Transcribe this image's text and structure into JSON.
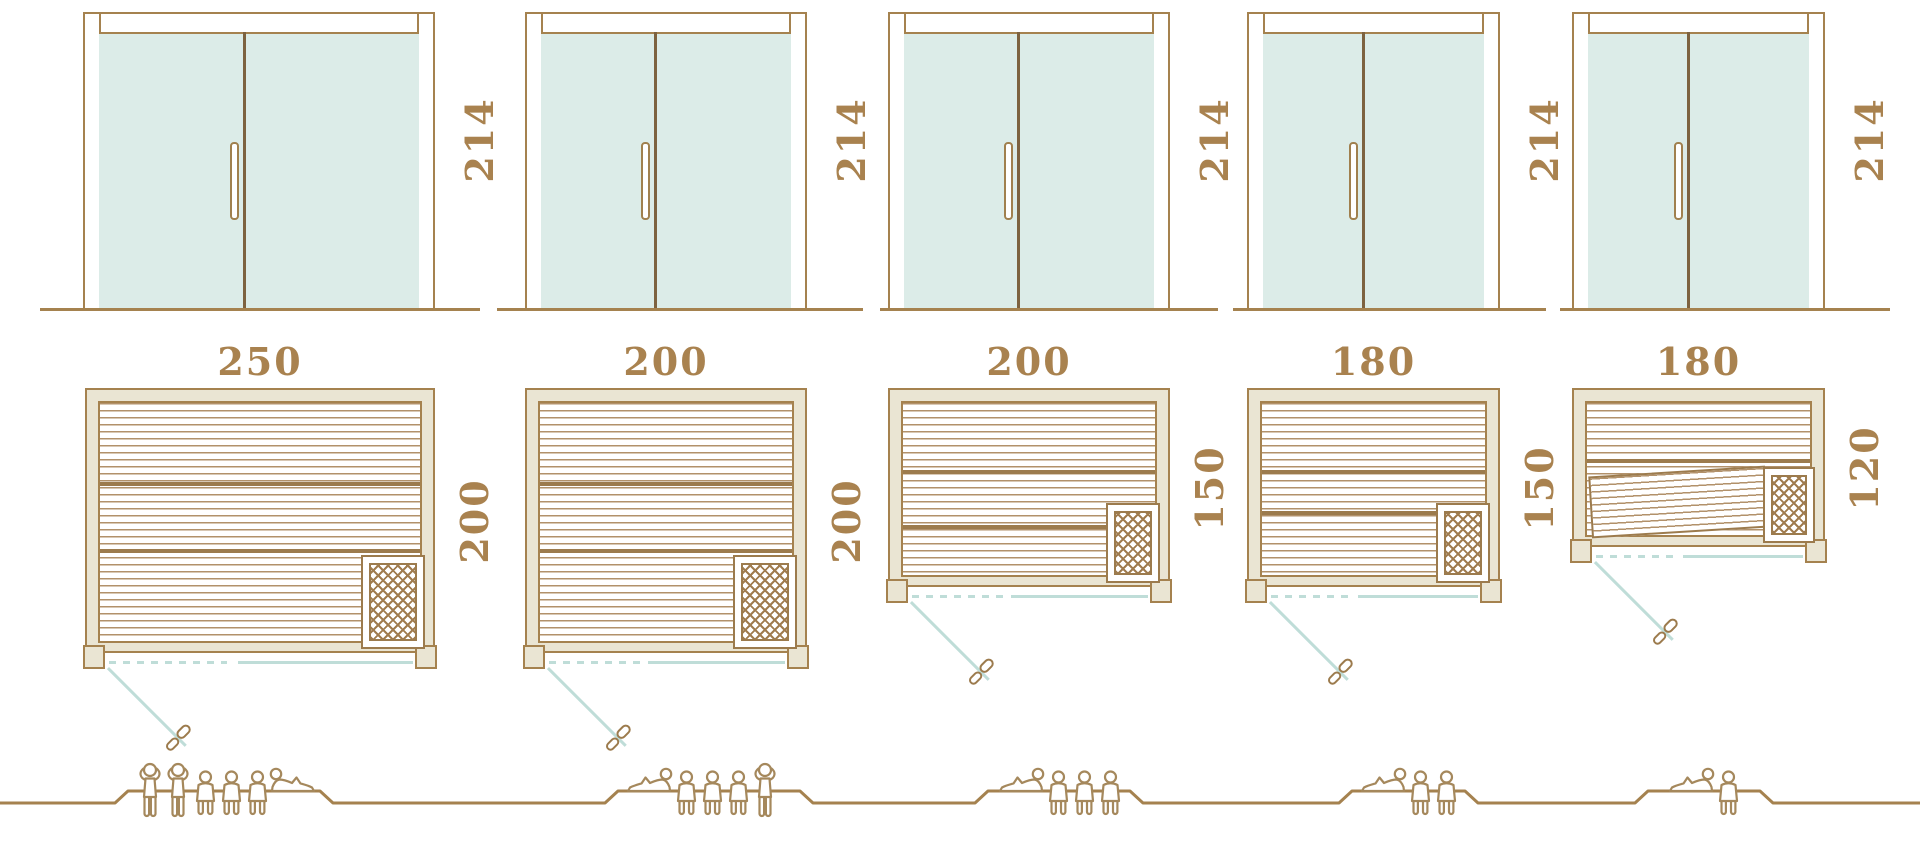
{
  "units": [
    {
      "door_height": "214",
      "plan_width": "250",
      "plan_depth": "200",
      "capacity": 6,
      "figures": [
        "standing",
        "standing",
        "seated",
        "seated",
        "seated",
        "reclining_mirrored"
      ]
    },
    {
      "door_height": "214",
      "plan_width": "200",
      "plan_depth": "200",
      "capacity": 5,
      "figures": [
        "reclining",
        "seated",
        "seated",
        "seated",
        "standing"
      ]
    },
    {
      "door_height": "214",
      "plan_width": "200",
      "plan_depth": "150",
      "capacity": 4,
      "figures": [
        "reclining",
        "seated",
        "seated",
        "seated"
      ]
    },
    {
      "door_height": "214",
      "plan_width": "180",
      "plan_depth": "150",
      "capacity": 3,
      "figures": [
        "reclining",
        "seated",
        "seated"
      ]
    },
    {
      "door_height": "214",
      "plan_width": "180",
      "plan_depth": "120",
      "capacity": 2,
      "figures": [
        "reclining",
        "seated"
      ]
    }
  ],
  "colors": {
    "outline": "#a5824f",
    "dark_line": "#8a6b42",
    "label_text": "#a9824f",
    "frame_fill": "#eae5d3",
    "glass_fill": "#dcece8",
    "glass_accent": "#bfddd8",
    "slat_line": "#b2916a",
    "figure_outline": "#a5885c"
  }
}
